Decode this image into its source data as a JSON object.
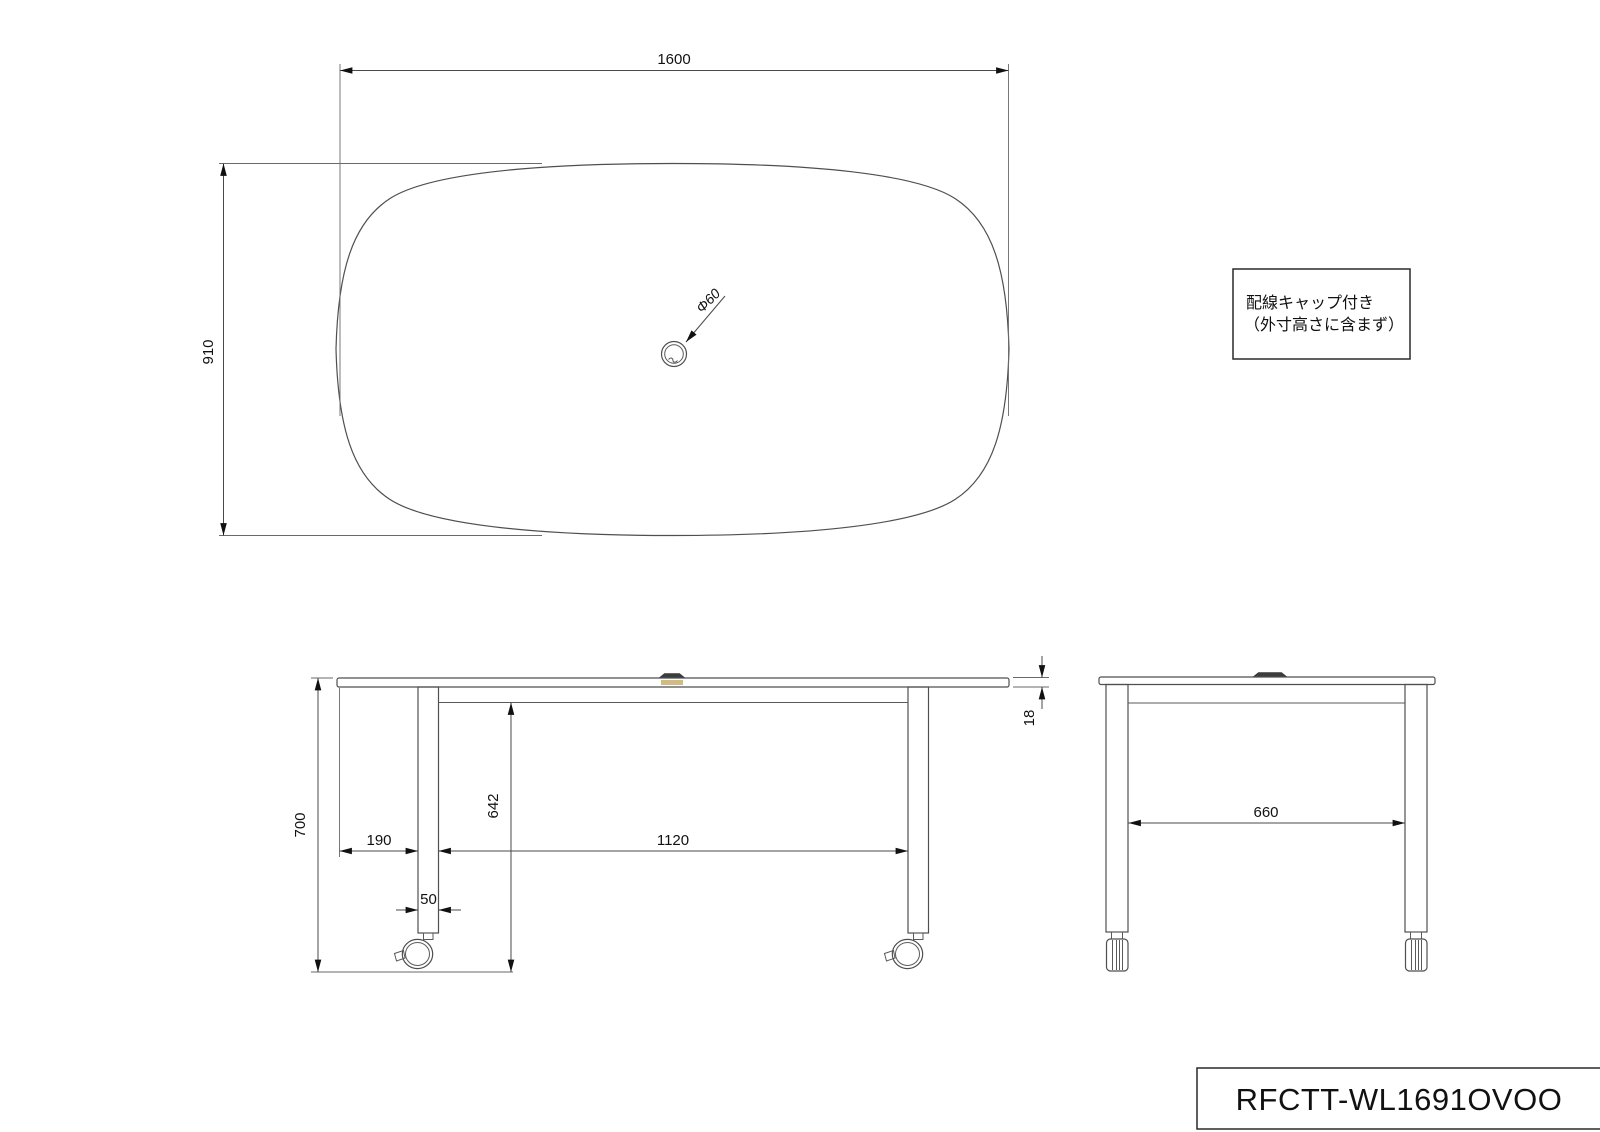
{
  "drawing": {
    "background": "#ffffff",
    "object_line_color": "#4f4f4f",
    "dimension_line_color": "#4a4a4a",
    "text_color": "#111111",
    "cap_fill_color": "#3d3d3d",
    "cap_wood_color": "#c9b06c"
  },
  "top_view": {
    "width_dim": "1600",
    "depth_dim": "910",
    "hole_dim": "Φ60"
  },
  "front_view": {
    "height_dim": "700",
    "side_overhang_dim": "190",
    "leg_width_dim": "50",
    "underframe_clearance_dim": "642",
    "leg_pitch_dim": "1120",
    "top_thickness_dim": "18"
  },
  "side_view": {
    "leg_pitch_dim": "660"
  },
  "note_box": {
    "line1": "配線キャップ付き",
    "line2": "（外寸高さに含まず）"
  },
  "title_block": {
    "model_number": "RFCTT-WL1691OVOO"
  }
}
